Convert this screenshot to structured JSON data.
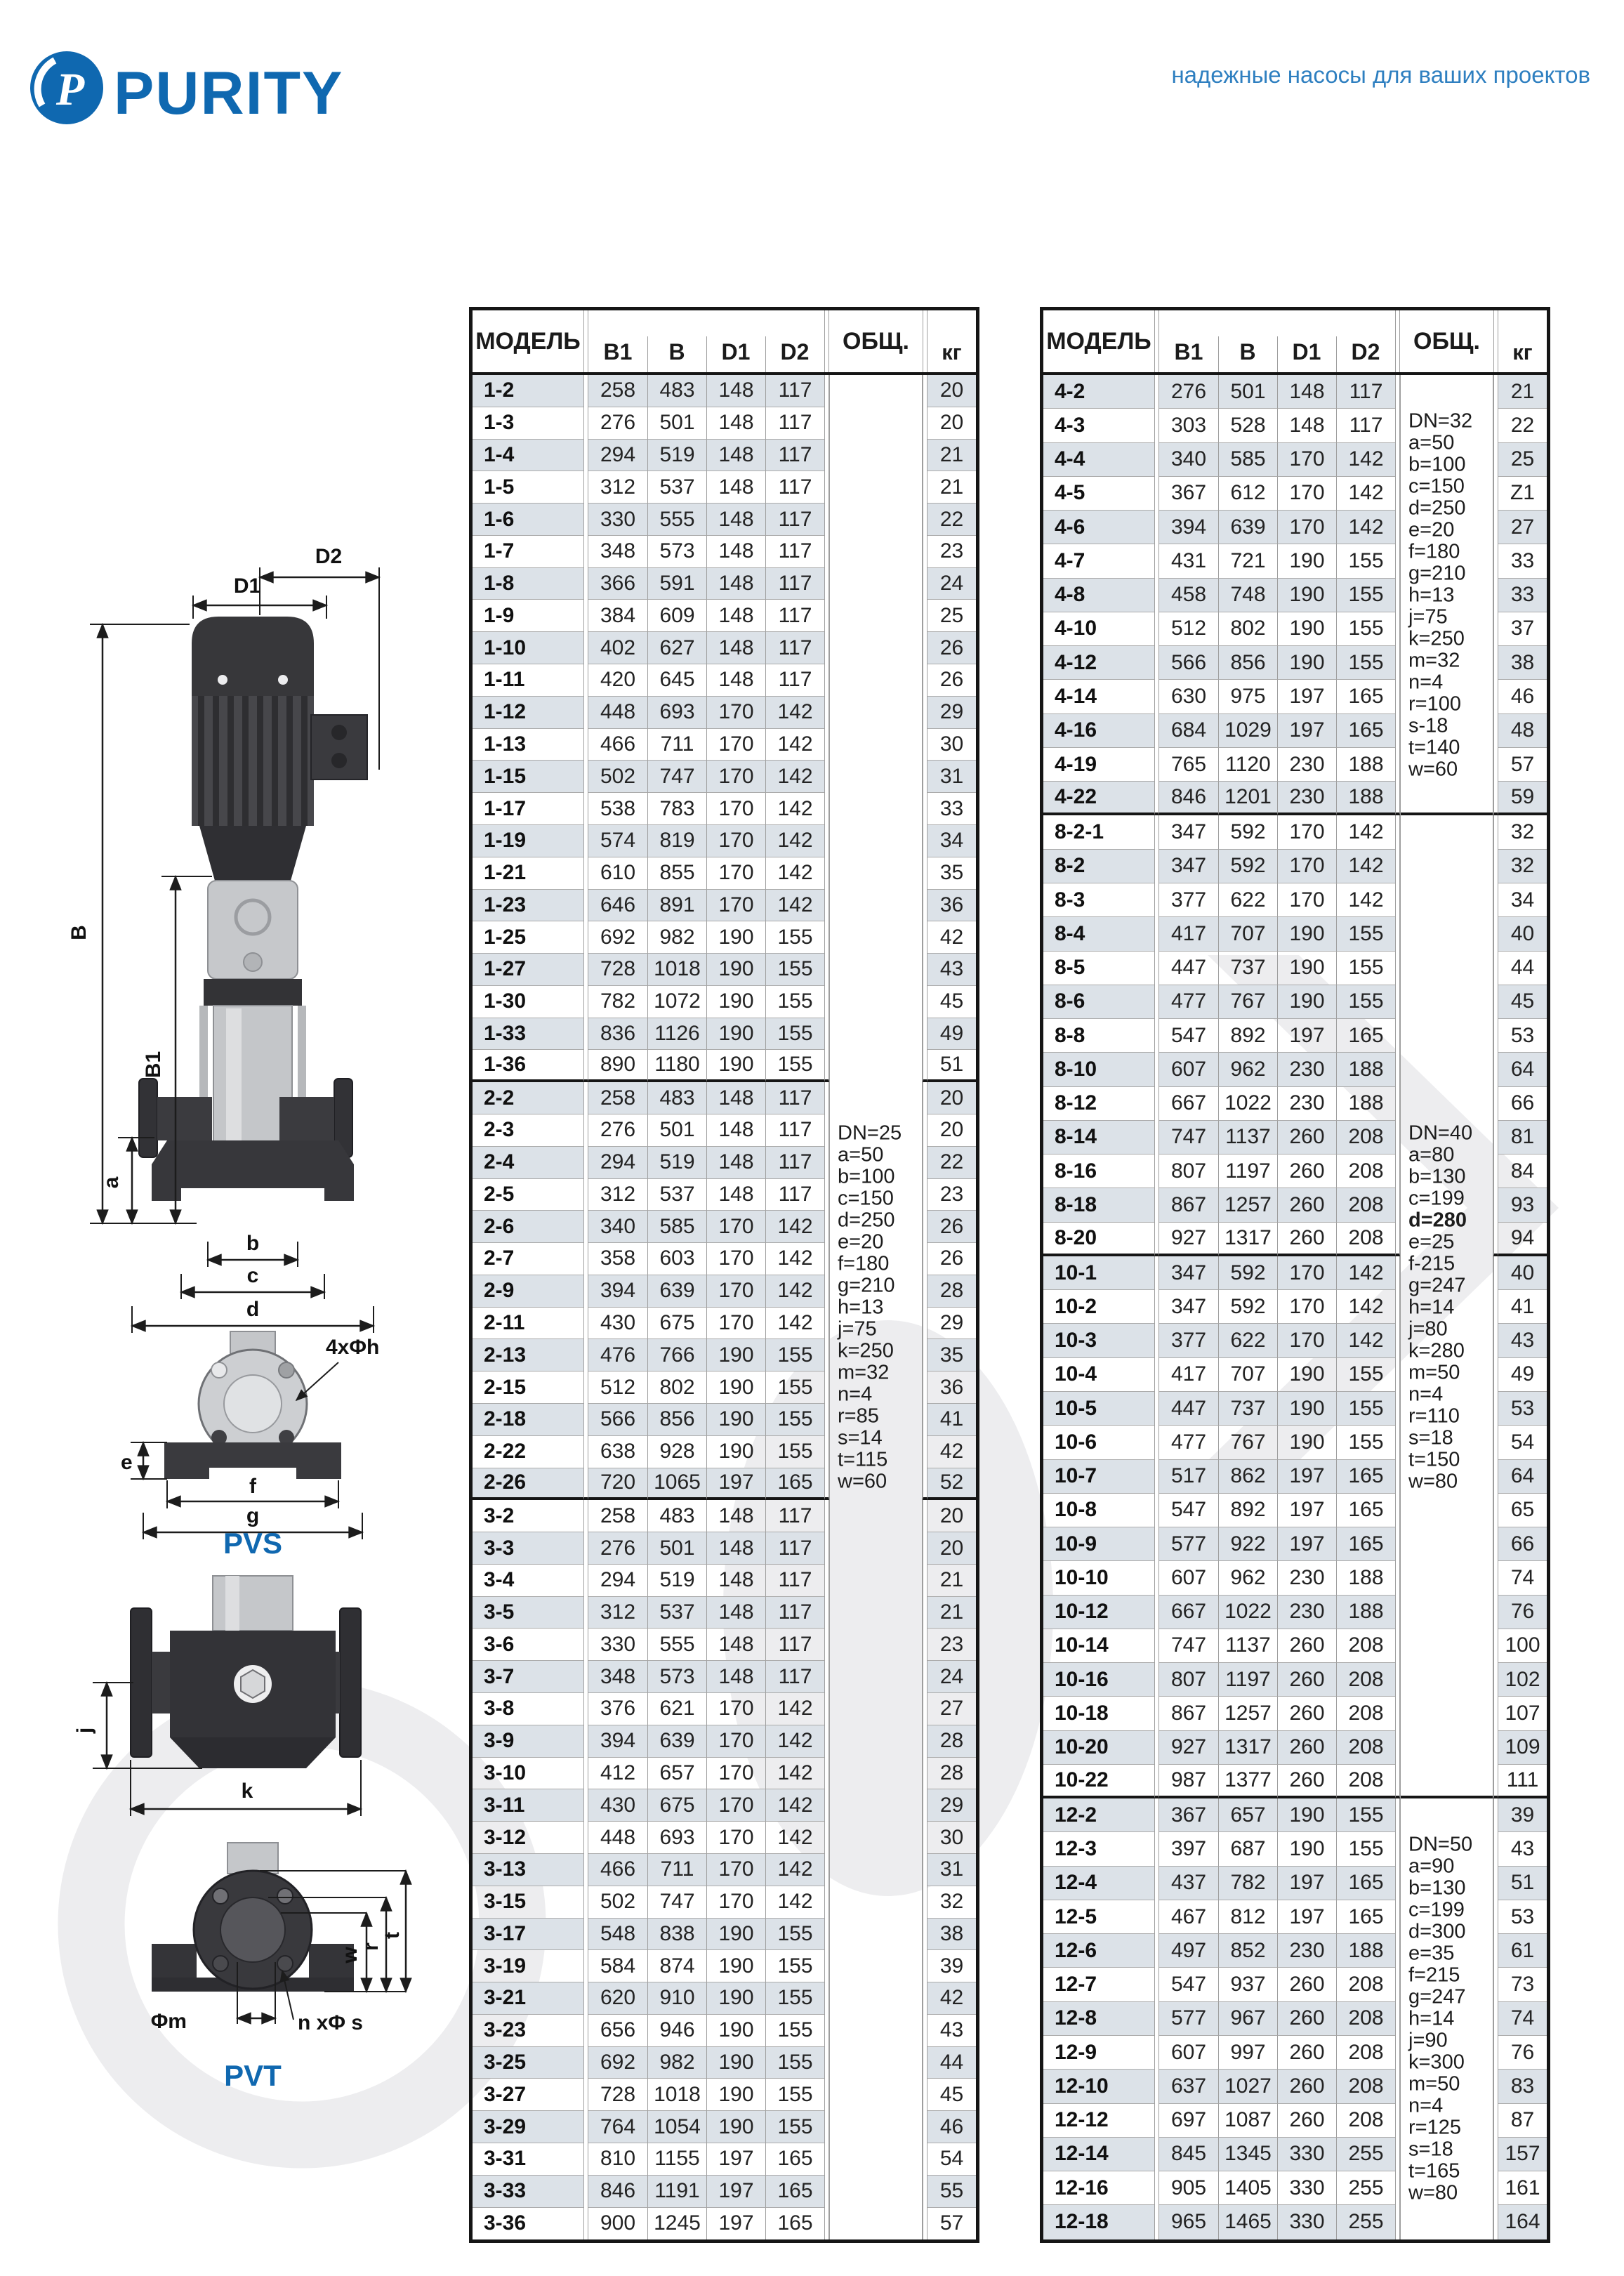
{
  "header": {
    "logo_text": "PURITY",
    "tagline": "надежные насосы для ваших проектов"
  },
  "colors": {
    "accent_blue": "#0f68b0",
    "tagline_blue": "#2e7fc0",
    "row_shade": "#dce2e8",
    "border_dark": "#151515",
    "border_light": "#9e9e9e"
  },
  "table_headers": {
    "model": "МОДЕЛЬ",
    "b1": "B1",
    "b": "B",
    "d1": "D1",
    "d2": "D2",
    "total": "ОБЩ.",
    "kg": "кг"
  },
  "diagram_pvs": {
    "label": "PVS",
    "dims": {
      "d2": "D2",
      "d1": "D1",
      "b": "B",
      "b1": "B1",
      "a": "a",
      "bb": "b",
      "c": "c",
      "d": "d",
      "e": "e",
      "f": "f",
      "g": "g",
      "holes": "4xΦh"
    }
  },
  "diagram_pvt": {
    "label": "PVT",
    "dims": {
      "j": "j",
      "k": "k",
      "w": "w",
      "r": "r",
      "t": "t",
      "m": "Φm",
      "ns": "n xΦ s"
    }
  },
  "left_table": {
    "note_blocks": [
      {
        "applies_to_groups": [
          0,
          1,
          2
        ],
        "lines": [
          "DN=25",
          "a=50",
          "b=100",
          "c=150",
          "d=250",
          "e=20",
          "f=180",
          "g=210",
          "h=13",
          "j=75",
          "k=250",
          "m=32",
          "n=4",
          "r=85",
          "s=14",
          "t=115",
          "w=60"
        ],
        "bold_lines": []
      }
    ],
    "groups": [
      {
        "rows": [
          [
            "1-2",
            258,
            483,
            148,
            117,
            20
          ],
          [
            "1-3",
            276,
            501,
            148,
            117,
            20
          ],
          [
            "1-4",
            294,
            519,
            148,
            117,
            21
          ],
          [
            "1-5",
            312,
            537,
            148,
            117,
            21
          ],
          [
            "1-6",
            330,
            555,
            148,
            117,
            22
          ],
          [
            "1-7",
            348,
            573,
            148,
            117,
            23
          ],
          [
            "1-8",
            366,
            591,
            148,
            117,
            24
          ],
          [
            "1-9",
            384,
            609,
            148,
            117,
            25
          ],
          [
            "1-10",
            402,
            627,
            148,
            117,
            26
          ],
          [
            "1-11",
            420,
            645,
            148,
            117,
            26
          ],
          [
            "1-12",
            448,
            693,
            170,
            142,
            29
          ],
          [
            "1-13",
            466,
            711,
            170,
            142,
            30
          ],
          [
            "1-15",
            502,
            747,
            170,
            142,
            31
          ],
          [
            "1-17",
            538,
            783,
            170,
            142,
            33
          ],
          [
            "1-19",
            574,
            819,
            170,
            142,
            34
          ],
          [
            "1-21",
            610,
            855,
            170,
            142,
            35
          ],
          [
            "1-23",
            646,
            891,
            170,
            142,
            36
          ],
          [
            "1-25",
            692,
            982,
            190,
            155,
            42
          ],
          [
            "1-27",
            728,
            1018,
            190,
            155,
            43
          ],
          [
            "1-30",
            782,
            1072,
            190,
            155,
            45
          ],
          [
            "1-33",
            836,
            1126,
            190,
            155,
            49
          ],
          [
            "1-36",
            890,
            1180,
            190,
            155,
            51
          ]
        ]
      },
      {
        "rows": [
          [
            "2-2",
            258,
            483,
            148,
            117,
            20
          ],
          [
            "2-3",
            276,
            501,
            148,
            117,
            20
          ],
          [
            "2-4",
            294,
            519,
            148,
            117,
            22
          ],
          [
            "2-5",
            312,
            537,
            148,
            117,
            23
          ],
          [
            "2-6",
            340,
            585,
            170,
            142,
            26
          ],
          [
            "2-7",
            358,
            603,
            170,
            142,
            26
          ],
          [
            "2-9",
            394,
            639,
            170,
            142,
            28
          ],
          [
            "2-11",
            430,
            675,
            170,
            142,
            29
          ],
          [
            "2-13",
            476,
            766,
            190,
            155,
            35
          ],
          [
            "2-15",
            512,
            802,
            190,
            155,
            36
          ],
          [
            "2-18",
            566,
            856,
            190,
            155,
            41
          ],
          [
            "2-22",
            638,
            928,
            190,
            155,
            42
          ],
          [
            "2-26",
            720,
            1065,
            197,
            165,
            52
          ]
        ]
      },
      {
        "rows": [
          [
            "3-2",
            258,
            483,
            148,
            117,
            20
          ],
          [
            "3-3",
            276,
            501,
            148,
            117,
            20
          ],
          [
            "3-4",
            294,
            519,
            148,
            117,
            21
          ],
          [
            "3-5",
            312,
            537,
            148,
            117,
            21
          ],
          [
            "3-6",
            330,
            555,
            148,
            117,
            23
          ],
          [
            "3-7",
            348,
            573,
            148,
            117,
            24
          ],
          [
            "3-8",
            376,
            621,
            170,
            142,
            27
          ],
          [
            "3-9",
            394,
            639,
            170,
            142,
            28
          ],
          [
            "3-10",
            412,
            657,
            170,
            142,
            28
          ],
          [
            "3-11",
            430,
            675,
            170,
            142,
            29
          ],
          [
            "3-12",
            448,
            693,
            170,
            142,
            30
          ],
          [
            "3-13",
            466,
            711,
            170,
            142,
            31
          ],
          [
            "3-15",
            502,
            747,
            170,
            142,
            32
          ],
          [
            "3-17",
            548,
            838,
            190,
            155,
            38
          ],
          [
            "3-19",
            584,
            874,
            190,
            155,
            39
          ],
          [
            "3-21",
            620,
            910,
            190,
            155,
            42
          ],
          [
            "3-23",
            656,
            946,
            190,
            155,
            43
          ],
          [
            "3-25",
            692,
            982,
            190,
            155,
            44
          ],
          [
            "3-27",
            728,
            1018,
            190,
            155,
            45
          ],
          [
            "3-29",
            764,
            1054,
            190,
            155,
            46
          ],
          [
            "3-31",
            810,
            1155,
            197,
            165,
            54
          ],
          [
            "3-33",
            846,
            1191,
            197,
            165,
            55
          ],
          [
            "3-36",
            900,
            1245,
            197,
            165,
            57
          ]
        ]
      }
    ]
  },
  "right_table": {
    "note_blocks": [
      {
        "applies_to_groups": [
          0
        ],
        "lines": [
          "DN=32",
          "a=50",
          "b=100",
          "c=150",
          "d=250",
          "e=20",
          "f=180",
          "g=210",
          "h=13",
          "j=75",
          "k=250",
          "m=32",
          "n=4",
          "r=100",
          "s-18",
          "t=140",
          "w=60"
        ],
        "bold_lines": []
      },
      {
        "applies_to_groups": [
          1,
          2
        ],
        "lines": [
          "DN=40",
          "a=80",
          "b=130",
          "c=199",
          "d=280",
          "e=25",
          "f-215",
          "g=247",
          "h=14",
          "j=80",
          "k=280",
          "m=50",
          "n=4",
          "r=110",
          "s=18",
          "t=150",
          "w=80"
        ],
        "bold_lines": [
          "d=280"
        ]
      },
      {
        "applies_to_groups": [
          3
        ],
        "lines": [
          "DN=50",
          "a=90",
          "b=130",
          "c=199",
          "d=300",
          "e=35",
          "f=215",
          "g=247",
          "h=14",
          "j=90",
          "k=300",
          "m=50",
          "n=4",
          "r=125",
          "s=18",
          "t=165",
          "w=80"
        ],
        "bold_lines": []
      }
    ],
    "groups": [
      {
        "rows": [
          [
            "4-2",
            276,
            501,
            148,
            117,
            21
          ],
          [
            "4-3",
            303,
            528,
            148,
            117,
            22
          ],
          [
            "4-4",
            340,
            585,
            170,
            142,
            25
          ],
          [
            "4-5",
            367,
            612,
            170,
            142,
            "Z1"
          ],
          [
            "4-6",
            394,
            639,
            170,
            142,
            27
          ],
          [
            "4-7",
            431,
            721,
            190,
            155,
            33
          ],
          [
            "4-8",
            458,
            748,
            190,
            155,
            33
          ],
          [
            "4-10",
            512,
            802,
            190,
            155,
            37
          ],
          [
            "4-12",
            566,
            856,
            190,
            155,
            38
          ],
          [
            "4-14",
            630,
            975,
            197,
            165,
            46
          ],
          [
            "4-16",
            684,
            1029,
            197,
            165,
            48
          ],
          [
            "4-19",
            765,
            1120,
            230,
            188,
            57
          ],
          [
            "4-22",
            846,
            1201,
            230,
            188,
            59
          ]
        ]
      },
      {
        "rows": [
          [
            "8-2-1",
            347,
            592,
            170,
            142,
            32
          ],
          [
            "8-2",
            347,
            592,
            170,
            142,
            32
          ],
          [
            "8-3",
            377,
            622,
            170,
            142,
            34
          ],
          [
            "8-4",
            417,
            707,
            190,
            155,
            40
          ],
          [
            "8-5",
            447,
            737,
            190,
            155,
            44
          ],
          [
            "8-6",
            477,
            767,
            190,
            155,
            45
          ],
          [
            "8-8",
            547,
            892,
            197,
            165,
            53
          ],
          [
            "8-10",
            607,
            962,
            230,
            188,
            64
          ],
          [
            "8-12",
            667,
            1022,
            230,
            188,
            66
          ],
          [
            "8-14",
            747,
            1137,
            260,
            208,
            81
          ],
          [
            "8-16",
            807,
            1197,
            260,
            208,
            84
          ],
          [
            "8-18",
            867,
            1257,
            260,
            208,
            93
          ],
          [
            "8-20",
            927,
            1317,
            260,
            208,
            94
          ]
        ]
      },
      {
        "rows": [
          [
            "10-1",
            347,
            592,
            170,
            142,
            40
          ],
          [
            "10-2",
            347,
            592,
            170,
            142,
            41
          ],
          [
            "10-3",
            377,
            622,
            170,
            142,
            43
          ],
          [
            "10-4",
            417,
            707,
            190,
            155,
            49
          ],
          [
            "10-5",
            447,
            737,
            190,
            155,
            53
          ],
          [
            "10-6",
            477,
            767,
            190,
            155,
            54
          ],
          [
            "10-7",
            517,
            862,
            197,
            165,
            64
          ],
          [
            "10-8",
            547,
            892,
            197,
            165,
            65
          ],
          [
            "10-9",
            577,
            922,
            197,
            165,
            66
          ],
          [
            "10-10",
            607,
            962,
            230,
            188,
            74
          ],
          [
            "10-12",
            667,
            1022,
            230,
            188,
            76
          ],
          [
            "10-14",
            747,
            1137,
            260,
            208,
            100
          ],
          [
            "10-16",
            807,
            1197,
            260,
            208,
            102
          ],
          [
            "10-18",
            867,
            1257,
            260,
            208,
            107
          ],
          [
            "10-20",
            927,
            1317,
            260,
            208,
            109
          ],
          [
            "10-22",
            987,
            1377,
            260,
            208,
            111
          ]
        ]
      },
      {
        "rows": [
          [
            "12-2",
            367,
            657,
            190,
            155,
            39
          ],
          [
            "12-3",
            397,
            687,
            190,
            155,
            43
          ],
          [
            "12-4",
            437,
            782,
            197,
            165,
            51
          ],
          [
            "12-5",
            467,
            812,
            197,
            165,
            53
          ],
          [
            "12-6",
            497,
            852,
            230,
            188,
            61
          ],
          [
            "12-7",
            547,
            937,
            260,
            208,
            73
          ],
          [
            "12-8",
            577,
            967,
            260,
            208,
            74
          ],
          [
            "12-9",
            607,
            997,
            260,
            208,
            76
          ],
          [
            "12-10",
            637,
            1027,
            260,
            208,
            83
          ],
          [
            "12-12",
            697,
            1087,
            260,
            208,
            87
          ],
          [
            "12-14",
            845,
            1345,
            330,
            255,
            157
          ],
          [
            "12-16",
            905,
            1405,
            330,
            255,
            161
          ],
          [
            "12-18",
            965,
            1465,
            330,
            255,
            164
          ]
        ]
      }
    ]
  }
}
